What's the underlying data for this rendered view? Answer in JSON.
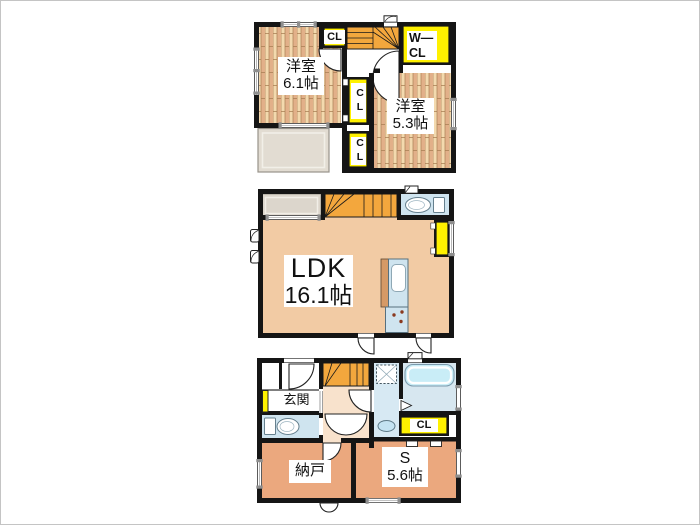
{
  "image_type": "floor-plan",
  "colors": {
    "wall": "#151515",
    "wood_light": "#F3D9AE",
    "wood_dark": "#E2B089",
    "wood_line": "#A87E52",
    "ldk_floor": "#F2CBA4",
    "hall_floor": "#F8E2CC",
    "room_floor_1f": "#EBA87E",
    "closet_yellow": "#FFF100",
    "stairs_orange": "#F3A73D",
    "wet_area_blue": "#D3E6F0",
    "tub_cyan": "#C9EDF7",
    "balcony_grey": "#E2DCD2"
  },
  "floor3": {
    "room_61": {
      "name": "洋室",
      "size": "6.1帖"
    },
    "room_53": {
      "name": "洋室",
      "size": "5.3帖"
    },
    "closet_top": "CL",
    "closet_middle": "CL",
    "closet_bottom": "CL",
    "walk_in_closet": {
      "line1": "W—",
      "line2": "CL"
    }
  },
  "floor2": {
    "ldk": {
      "name": "LDK",
      "size": "16.1帖"
    }
  },
  "floor1": {
    "entrance": "玄関",
    "closet": "CL",
    "storage_room": "納戸",
    "service_room": {
      "name": "S",
      "size": "5.6帖"
    }
  }
}
